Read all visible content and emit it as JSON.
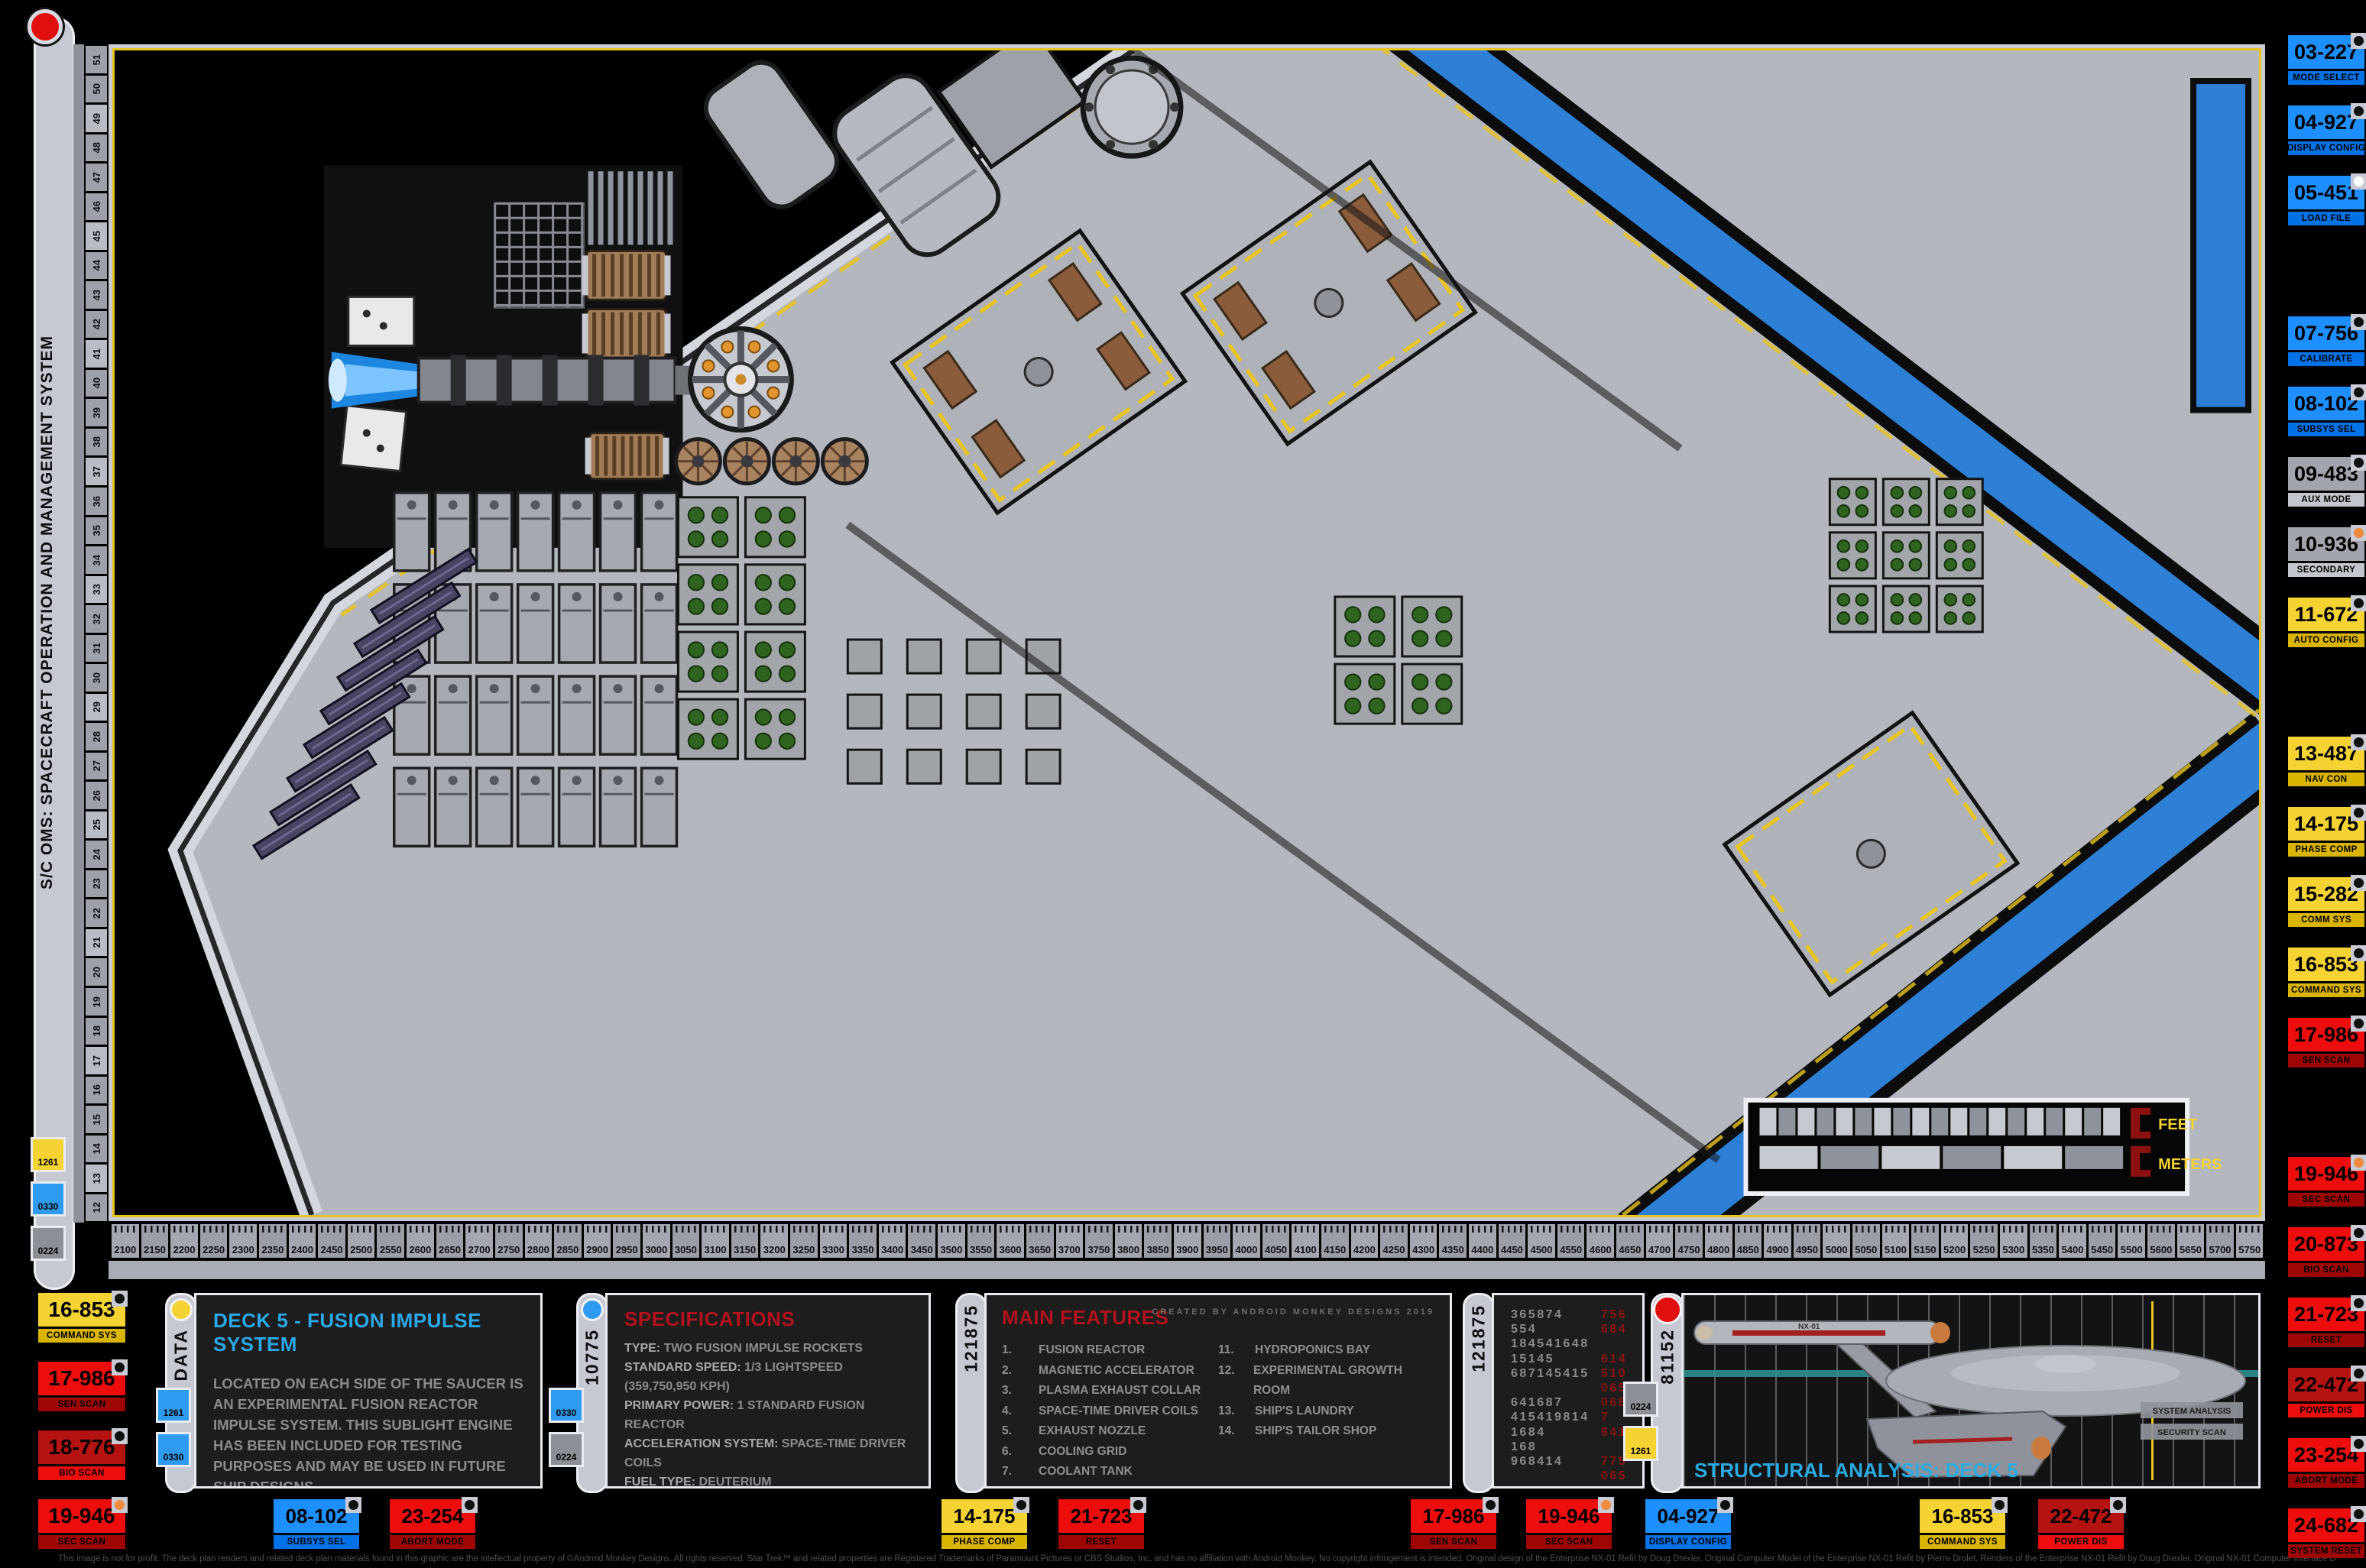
{
  "header": {
    "system_title": "S/C OMS: SPACECRAFT OPERATION AND MANAGEMENT SYSTEM"
  },
  "colors": {
    "blue": "#1E8FFF",
    "yellow": "#F5D333",
    "red": "#EE0D0D",
    "dark_red": "#B51212",
    "gray": "#A2A5AD",
    "orange_dot": "#F08A3C",
    "cyan_title": "#2AA8E8",
    "red_title": "#B2121E",
    "corridor_blue": "#2E7FD6",
    "hazard_yellow": "#E8C520"
  },
  "rulers": {
    "left_labels": [
      "51",
      "50",
      "49",
      "48",
      "47",
      "46",
      "45",
      "44",
      "43",
      "42",
      "41",
      "40",
      "39",
      "38",
      "37",
      "36",
      "35",
      "34",
      "33",
      "32",
      "31",
      "30",
      "29",
      "28",
      "27",
      "26",
      "25",
      "24",
      "23",
      "22",
      "21",
      "20",
      "19",
      "18",
      "17",
      "16",
      "15",
      "14",
      "13",
      "12"
    ],
    "bottom_labels": [
      "2100",
      "2150",
      "2200",
      "2250",
      "2300",
      "2350",
      "2400",
      "2450",
      "2500",
      "2550",
      "2600",
      "2650",
      "2700",
      "2750",
      "2800",
      "2850",
      "2900",
      "2950",
      "3000",
      "3050",
      "3100",
      "3150",
      "3200",
      "3250",
      "3300",
      "3350",
      "3400",
      "3450",
      "3500",
      "3550",
      "3600",
      "3650",
      "3700",
      "3750",
      "3800",
      "3850",
      "3900",
      "3950",
      "4000",
      "4050",
      "4100",
      "4150",
      "4200",
      "4250",
      "4300",
      "4350",
      "4400",
      "4450",
      "4500",
      "4550",
      "4600",
      "4650",
      "4700",
      "4750",
      "4800",
      "4850",
      "4900",
      "4950",
      "5000",
      "5050",
      "5100",
      "5150",
      "5200",
      "5250",
      "5300",
      "5350",
      "5400",
      "5450",
      "5500",
      "5600",
      "5650",
      "5700",
      "5750"
    ]
  },
  "right_buttons": [
    {
      "id": "03-227",
      "label": "MODE SELECT",
      "color": "blue",
      "dot": "black"
    },
    {
      "id": "04-927",
      "label": "DISPLAY CONFIG",
      "color": "blue",
      "dot": "black"
    },
    {
      "id": "05-451",
      "label": "LOAD FILE",
      "color": "blue",
      "dot": "white"
    },
    {
      "id": "07-756",
      "label": "CALIBRATE",
      "color": "blue",
      "dot": "black"
    },
    {
      "id": "08-102",
      "label": "SUBSYS SEL",
      "color": "blue",
      "dot": "black"
    },
    {
      "id": "09-483",
      "label": "AUX MODE",
      "color": "gray",
      "dot": "black"
    },
    {
      "id": "10-936",
      "label": "SECONDARY",
      "color": "gray",
      "dot": "orange"
    },
    {
      "id": "11-672",
      "label": "AUTO CONFIG",
      "color": "yellow",
      "dot": "black"
    },
    {
      "id": "13-487",
      "label": "NAV CON",
      "color": "yellow",
      "dot": "black"
    },
    {
      "id": "14-175",
      "label": "PHASE COMP",
      "color": "yellow",
      "dot": "black"
    },
    {
      "id": "15-282",
      "label": "COMM SYS",
      "color": "yellow",
      "dot": "black"
    },
    {
      "id": "16-853",
      "label": "COMMAND SYS",
      "color": "yellow",
      "dot": "black"
    },
    {
      "id": "17-986",
      "label": "SEN SCAN",
      "color": "red",
      "dot": "black"
    },
    {
      "id": "19-946",
      "label": "SEC SCAN",
      "color": "red",
      "dot": "orange"
    },
    {
      "id": "20-873",
      "label": "BIO SCAN",
      "color": "red",
      "dot": "black"
    },
    {
      "id": "21-723",
      "label": "RESET",
      "color": "red",
      "dot": "black"
    },
    {
      "id": "22-472",
      "label": "POWER DIS",
      "color": "darkred",
      "dot": "black"
    },
    {
      "id": "23-254",
      "label": "ABORT MODE",
      "color": "red",
      "dot": "black"
    },
    {
      "id": "24-682",
      "label": "SYSTEM RESET",
      "color": "red",
      "dot": "black"
    }
  ],
  "left_buttons": [
    {
      "id": "16-853",
      "label": "COMMAND SYS",
      "color": "yellow",
      "dot": "black"
    },
    {
      "id": "17-986",
      "label": "SEN SCAN",
      "color": "red",
      "dot": "black"
    },
    {
      "id": "18-776",
      "label": "BIO SCAN",
      "color": "darkred",
      "dot": "black"
    },
    {
      "id": "19-946",
      "label": "SEC SCAN",
      "color": "red",
      "dot": "orange"
    }
  ],
  "bottom_buttons": [
    {
      "id": "08-102",
      "label": "SUBSYS SEL",
      "color": "blue",
      "dot": "black"
    },
    {
      "id": "23-254",
      "label": "ABORT MODE",
      "color": "red",
      "dot": "black"
    },
    {
      "id": "14-175",
      "label": "PHASE COMP",
      "color": "yellow",
      "dot": "black"
    },
    {
      "id": "21-723",
      "label": "RESET",
      "color": "red",
      "dot": "black"
    },
    {
      "id": "17-986",
      "label": "SEN SCAN",
      "color": "red",
      "dot": "black"
    },
    {
      "id": "19-946",
      "label": "SEC SCAN",
      "color": "red",
      "dot": "orange"
    },
    {
      "id": "04-927",
      "label": "DISPLAY CONFIG",
      "color": "blue",
      "dot": "black"
    },
    {
      "id": "16-853",
      "label": "COMMAND SYS",
      "color": "yellow",
      "dot": "black"
    },
    {
      "id": "22-472",
      "label": "POWER DIS",
      "color": "darkred",
      "dot": "black"
    }
  ],
  "sidebar_chips": [
    {
      "label": "1261",
      "color": "yellow"
    },
    {
      "label": "0330",
      "color": "blue"
    },
    {
      "label": "0224",
      "color": "gray"
    }
  ],
  "data_panel": {
    "tab": "DATA",
    "chips": [
      {
        "label": "1261",
        "color": "blue"
      },
      {
        "label": "0330",
        "color": "blue"
      }
    ],
    "title": "DECK 5 - FUSION IMPULSE SYSTEM",
    "body": "LOCATED ON EACH SIDE OF THE SAUCER IS AN EXPERIMENTAL FUSION REACTOR IMPULSE SYSTEM. THIS SUBLIGHT ENGINE HAS BEEN INCLUDED FOR TESTING PURPOSES AND MAY BE USED IN FUTURE SHIP DESIGNS."
  },
  "specs_panel": {
    "tab": "10775",
    "chips": [
      {
        "label": "0330",
        "color": "blue"
      },
      {
        "label": "0224",
        "color": "gray"
      }
    ],
    "title": "SPECIFICATIONS",
    "rows": [
      {
        "label": "TYPE:",
        "value": "TWO FUSION IMPULSE ROCKETS"
      },
      {
        "label": "STANDARD SPEED:",
        "value": "1/3 LIGHTSPEED (359,750,950 KPH)"
      },
      {
        "label": "PRIMARY POWER:",
        "value": "1 STANDARD FUSION REACTOR"
      },
      {
        "label": "ACCELERATION SYSTEM:",
        "value": "SPACE-TIME DRIVER COILS"
      },
      {
        "label": "FUEL TYPE:",
        "value": "DEUTERIUM"
      }
    ],
    "endurance_label": "ENDURANCE (UNREFUELED):",
    "endurance_lines": [
      "APPROXIMATELY SEVEN YEARS,",
      "NORMAL CRUISING SPEED"
    ]
  },
  "features_panel": {
    "tab": "121875",
    "title": "MAIN FEATURES",
    "credit": "CREATED BY ANDROID MONKEY DESIGNS 2019",
    "items_left": [
      {
        "num": "1.",
        "text": "FUSION REACTOR"
      },
      {
        "num": "2.",
        "text": "MAGNETIC ACCELERATOR"
      },
      {
        "num": "3.",
        "text": "PLASMA EXHAUST COLLAR"
      },
      {
        "num": "4.",
        "text": "SPACE-TIME DRIVER COILS"
      },
      {
        "num": "5.",
        "text": "EXHAUST NOZZLE"
      },
      {
        "num": "6.",
        "text": "COOLING GRID"
      },
      {
        "num": "7.",
        "text": "COOLANT TANK"
      },
      {
        "num": "8.",
        "text": "RCS THRUSTERS"
      },
      {
        "num": "9.",
        "text": "MONITORING STATION"
      },
      {
        "num": "10.",
        "text": "LIFE BOAT"
      }
    ],
    "items_right": [
      {
        "num": "11.",
        "text": "HYDROPONICS BAY"
      },
      {
        "num": "12.",
        "text": "EXPERIMENTAL GROWTH ROOM"
      },
      {
        "num": "13.",
        "text": "SHIP'S LAUNDRY"
      },
      {
        "num": "14.",
        "text": "SHIP'S TAILOR SHOP"
      }
    ]
  },
  "numbers_panel": {
    "tab": "121875",
    "rows": [
      {
        "left": "365874",
        "right": "756"
      },
      {
        "left": "554",
        "right": "684"
      },
      {
        "left": "184541648",
        "right": ""
      },
      {
        "left": "15145",
        "right": "614"
      },
      {
        "left": "687145415",
        "right": "510"
      },
      {
        "left": "",
        "right": "065"
      },
      {
        "left": "641687",
        "right": "068"
      },
      {
        "left": "415419814",
        "right": "7"
      },
      {
        "left": "1684",
        "right": "641"
      },
      {
        "left": "168",
        "right": ""
      },
      {
        "left": "968414",
        "right": "775"
      },
      {
        "left": "",
        "right": "065"
      }
    ]
  },
  "analysis_panel": {
    "tab": "81152",
    "chips": [
      {
        "label": "0224",
        "color": "gray"
      },
      {
        "label": "1261",
        "color": "yellow"
      }
    ],
    "title": "STRUCTURAL ANALYSIS: DECK 5",
    "tags": [
      "SYSTEM ANALYSIS",
      "SECURITY SCAN"
    ],
    "hull_marking": "NX-01"
  },
  "scale_legend": {
    "feet": "FEET",
    "meters": "METERS"
  },
  "footer": "This image is not for profit. The deck plan renders and related deck plan materials found in this graphic are the intellectual property of ©Android Monkey Designs. All rights reserved. Star Trek™ and related properties are Registered Trademarks of Paramount Pictures or CBS Studios, Inc. and has no affiliation with Android Monkey. No copyright infringement is intended. Original design of the Enterprise NX-01 Refit by Doug Drexler. Original Computer Model of the Enterprise NX-01 Refit by Pierre Drolet. Renders of the Enterprise NX-01 Refit by Doug Drexler. Original NX-01 Computer Interface Design by Mike Okuda."
}
